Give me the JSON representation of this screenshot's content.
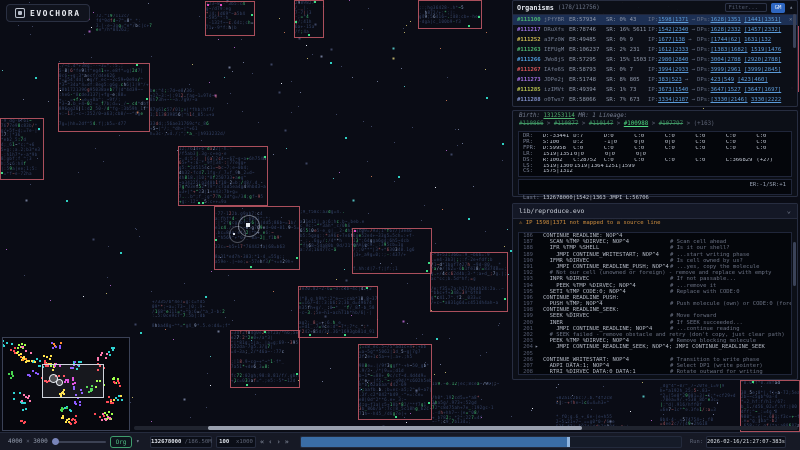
{
  "app": {
    "title": "EVOCHORA"
  },
  "organisms_panel": {
    "title": "Organisms",
    "count": "(178/112756)",
    "filter_placeholder": "Filter...",
    "gm_button": "GM",
    "collapse_icon": "▴",
    "close_icon": "×",
    "ip_label": "IP:",
    "dp_label": "DPs:",
    "rows": [
      {
        "id": "#111100",
        "id_color": "#4db56f",
        "name": "jPfYBR",
        "er": "ER:57934",
        "sr": "SR: 0% 43",
        "ip": "1598|1371",
        "dir": "→",
        "dp1": "1628|1351",
        "dp2": "[1441|1351]",
        "selected": true
      },
      {
        "id": "#111217",
        "id_color": "#9a6fe0",
        "name": "DRuXfs",
        "er": "ER:78746",
        "sr": "SR: 16% 5611",
        "ip": "1542|2340",
        "dir": "→",
        "dp1": "1628|2332",
        "dp2": "[1457|2332]",
        "selected": false
      },
      {
        "id": "#111252",
        "id_color": "#cdb94f",
        "name": "a3Fz0W",
        "er": "ER:49485",
        "sr": "SR: 0% 9",
        "ip": "1677|138",
        "dir": "→",
        "dp1": "[1744|62]",
        "dp2": "1631|132",
        "selected": false
      },
      {
        "id": "#111263",
        "id_color": "#4db56f",
        "name": "IEFUgM",
        "er": "ER:106237",
        "sr": "SR: 2% 231",
        "ip": "1612|2333",
        "dir": "→",
        "dp1": "[1383|1682]",
        "dp2": "1519|1476",
        "selected": false
      },
      {
        "id": "#111266",
        "id_color": "#4f9fe0",
        "name": "JWo8jS",
        "er": "ER:57295",
        "sr": "SR: 15% 1503",
        "ip": "2980|2840",
        "dir": "→",
        "dp1": "3004|2788",
        "dp2": "[2920|2788]",
        "selected": false
      },
      {
        "id": "#111267",
        "id_color": "#d9565a",
        "name": "IAfe6S",
        "er": "ER:58793",
        "sr": "SR: 0% 7",
        "ip": "3994|2933",
        "dir": "→",
        "dp1": "3999|2961",
        "dp2": "[3999|2845]",
        "selected": false
      },
      {
        "id": "#111273",
        "id_color": "#a06fe0",
        "name": "JDPe2j",
        "er": "ER:51748",
        "sr": "SR: 8% 805",
        "ip": "383|523",
        "dir": "→",
        "dp1": "423|549",
        "dp2": "[423|460]",
        "selected": false
      },
      {
        "id": "#111285",
        "id_color": "#b9c24f",
        "name": "izIMVt",
        "er": "ER:49394",
        "sr": "SR: 1% 73",
        "ip": "3673|1540",
        "dir": "→",
        "dp1": "3647|1527",
        "dp2": "[3647|1697]",
        "selected": false
      },
      {
        "id": "#111288",
        "id_color": "#7f8fc9",
        "name": "o0Tws7",
        "er": "ER:58066",
        "sr": "SR: 7% 673",
        "ip": "3334|2187",
        "dir": "→",
        "dp1": "[3330|2146]",
        "dp2": "3330|2222",
        "selected": false
      }
    ]
  },
  "details_panel": {
    "birth_label": "Birth: ",
    "birth_value": "131253114",
    "mr_label": " MR: 1 ",
    "lineage_label": "Lineage:",
    "lineage": [
      {
        "id": "#110866",
        "status": "dead"
      },
      {
        "id": "#110877",
        "status": "dead"
      },
      {
        "id": "#110147",
        "status": "dead"
      },
      {
        "id": "#100988",
        "status": "live"
      },
      {
        "id": "#107797",
        "status": "dead"
      }
    ],
    "lineage_sep": " > ",
    "lineage_more": "(+163)",
    "registers": [
      {
        "label": "DR:",
        "values": [
          "D:-33441",
          "D:7",
          "D:0",
          "C:0",
          "C:0",
          "C:0",
          "C:0",
          "C:0"
        ]
      },
      {
        "label": "PR:",
        "values": [
          "S:100",
          "D:2",
          "-1|0",
          "0|0",
          "0|0",
          "C:0",
          "C:0",
          "C:0"
        ]
      },
      {
        "label": "FPR:",
        "values": [
          "D:59958",
          "C:0",
          "C:0",
          "C:0",
          "C:0",
          "C:0",
          "C:0",
          "C:0"
        ]
      },
      {
        "label": "LR:",
        "values": [
          "1519|1351",
          "0|0",
          "0|0",
          "0|0"
        ]
      },
      {
        "label": "DS:",
        "values": [
          "R:1002",
          "C:28752",
          "C:0",
          "C:0",
          "C:0",
          "C:0",
          "L:366829",
          "(+27)"
        ]
      },
      {
        "label": "LS:",
        "values": [
          "1519|1300",
          "1519|1364",
          "1251|1599"
        ]
      },
      {
        "label": "CS:",
        "values": [
          "1575|1312"
        ]
      }
    ],
    "last_label": "Last: ",
    "last_value": "132678000|1542|1363 JMPI L:56706",
    "last_er": "ER:-1/SR:+1",
    "next_label": "Next: ",
    "next_value": "132678001|1598|1371 SEEK %PR2",
    "next_green": "=-1|0"
  },
  "source_panel": {
    "file": "lib/reproduce.evo",
    "chevron": "⌄",
    "warning_icon": "⚠",
    "warning_text": " IP 1598|1371 not mapped to a source line",
    "marker_icon": "▸",
    "lines": [
      {
        "n": "186",
        "code": "CONTINUE_READLINE: NOP^4",
        "cm": ""
      },
      {
        "n": "187",
        "code": "  SCAN %TMP %DIRVEC; NOP^4",
        "cm": "# Scan cell ahead"
      },
      {
        "n": "188",
        "code": "  IFR %TMP %SHELL",
        "cm": "# Is it our shell?"
      },
      {
        "n": "189",
        "code": "    JMPI CONTINUE_WRITESTART; NOP^4",
        "cm": "# ...start writing phase"
      },
      {
        "n": "190",
        "code": "  IFMR %DIRVEC",
        "cm": "# Is cell owned by us?"
      },
      {
        "n": "191",
        "code": "    JMPI CONTINUE_READLINE_PUSH; NOP^4",
        "cm": "# ...yes, copy the molecule"
      },
      {
        "n": "192",
        "code": "  # Not our cell (unowned or foreign) - remove and replace with empty",
        "cm": "",
        "comment_line": true
      },
      {
        "n": "193",
        "code": "  INPR %DIRVEC",
        "cm": "# If not passable..."
      },
      {
        "n": "194",
        "code": "    PEEK %TMP %DIRVEC; NOP^4",
        "cm": "# ...remove it"
      },
      {
        "n": "195",
        "code": "  SETI %TMP CODE:0; NOP^4",
        "cm": "# Replace with CODE:0"
      },
      {
        "n": "196",
        "code": "CONTINUE_READLINE_PUSH:",
        "cm": ""
      },
      {
        "n": "197",
        "code": "  PUSH %TMP; NOP^4",
        "cm": "# Push molecule (own) or CODE:0 (foreign/unowned)"
      },
      {
        "n": "198",
        "code": "CONTINUE_READLINE_SEEK:",
        "cm": ""
      },
      {
        "n": "199",
        "code": "  SEEK %DIRVEC",
        "cm": "# Move forward"
      },
      {
        "n": "200",
        "code": "  INER",
        "cm": "# If SEEK succeeded..."
      },
      {
        "n": "201",
        "code": "    JMPI CONTINUE_READLINE; NOP^4",
        "cm": "# ...continue reading"
      },
      {
        "n": "202",
        "code": "  # SEEK failed - remove obstacle and retry (don't copy, just clear path)",
        "cm": "",
        "comment_line": true
      },
      {
        "n": "203",
        "code": "  PEEK %TMP %DIRVEC; NOP^4",
        "cm": "# Remove blocking molecule"
      },
      {
        "n": "204",
        "code": "    JMPI CONTINUE_READLINE_SEEK; NOP^4; JMPI CONTINUE_READLINE_SEEK",
        "cm": "",
        "marker": true
      },
      {
        "n": "205",
        "code": "",
        "cm": ""
      },
      {
        "n": "206",
        "code": "CONTINUE_WRITESTART: NOP^4",
        "cm": "# Transition to write phase"
      },
      {
        "n": "207",
        "code": "  ADPI DATA:1; NOP^4",
        "cm": "# Select DP1 (write pointer)"
      },
      {
        "n": "208",
        "code": "  RTRI %DIRVEC DATA:0 DATA:1",
        "cm": "# Rotate outward for writing"
      }
    ]
  },
  "minimap": {
    "viewport": {
      "x": 39,
      "y": 26,
      "w": 62,
      "h": 34
    },
    "rings": [
      {
        "x": 46,
        "y": 36,
        "d": 7
      },
      {
        "x": 53,
        "y": 41,
        "d": 5
      }
    ]
  },
  "toolbar": {
    "world_w": "4000",
    "world_x": " × ",
    "world_h": "3000",
    "org_button": "Org",
    "org_caret": "▾",
    "tick": "132678000",
    "tick_total": " /186.50M",
    "speed": "100",
    "speed_mult": "  x1000",
    "controls": [
      "«",
      "‹",
      "›",
      "»"
    ],
    "progress_pct": 70.4,
    "run_label": "Run:",
    "run_value": "2026-02-16/21:27:07-383s"
  },
  "world": {
    "clusters": [
      {
        "x": 96,
        "y": 14,
        "w": 62,
        "h": 22,
        "b": 0
      },
      {
        "x": 205,
        "y": 1,
        "w": 48,
        "h": 33,
        "b": 1
      },
      {
        "x": 294,
        "y": 0,
        "w": 28,
        "h": 36,
        "b": 1
      },
      {
        "x": 418,
        "y": 0,
        "w": 62,
        "h": 27,
        "b": 1
      },
      {
        "x": 58,
        "y": 63,
        "w": 90,
        "h": 67,
        "b": 1
      },
      {
        "x": 150,
        "y": 84,
        "w": 84,
        "h": 57,
        "b": 0
      },
      {
        "x": 0,
        "y": 118,
        "w": 42,
        "h": 60,
        "b": 1
      },
      {
        "x": 178,
        "y": 146,
        "w": 88,
        "h": 58,
        "b": 1
      },
      {
        "x": 214,
        "y": 206,
        "w": 84,
        "h": 62,
        "b": 1
      },
      {
        "x": 300,
        "y": 210,
        "w": 70,
        "h": 46,
        "b": 0
      },
      {
        "x": 352,
        "y": 228,
        "w": 78,
        "h": 44,
        "b": 1
      },
      {
        "x": 430,
        "y": 252,
        "w": 76,
        "h": 58,
        "b": 1
      },
      {
        "x": 298,
        "y": 286,
        "w": 78,
        "h": 50,
        "b": 1
      },
      {
        "x": 152,
        "y": 300,
        "w": 78,
        "h": 30,
        "b": 0
      },
      {
        "x": 230,
        "y": 330,
        "w": 68,
        "h": 56,
        "b": 1
      },
      {
        "x": 358,
        "y": 344,
        "w": 72,
        "h": 74,
        "b": 1
      },
      {
        "x": 432,
        "y": 382,
        "w": 76,
        "h": 46,
        "b": 0
      },
      {
        "x": 556,
        "y": 396,
        "w": 72,
        "h": 34,
        "b": 0
      },
      {
        "x": 660,
        "y": 384,
        "w": 76,
        "h": 46,
        "b": 0
      },
      {
        "x": 740,
        "y": 380,
        "w": 58,
        "h": 50,
        "b": 1
      }
    ],
    "teal_markers": [
      [
        35,
        77
      ],
      [
        66,
        200
      ],
      [
        120,
        252
      ],
      [
        345,
        137
      ],
      [
        398,
        176
      ],
      [
        486,
        97
      ],
      [
        502,
        143
      ],
      [
        330,
        62
      ],
      [
        468,
        218
      ],
      [
        205,
        296
      ],
      [
        140,
        332
      ],
      [
        436,
        338
      ],
      [
        510,
        250
      ],
      [
        38,
        128
      ]
    ],
    "magenta_markers": [
      [
        207,
        4
      ],
      [
        220,
        4
      ],
      [
        794,
        27
      ],
      [
        791,
        87
      ],
      [
        354,
        230
      ],
      [
        88,
        18
      ]
    ],
    "red_edge_line": {
      "x": 797,
      "y": 26,
      "h": 66
    },
    "selection_rings": [
      {
        "x": 238,
        "y": 215,
        "d": 20,
        "o": 0.55
      },
      {
        "x": 229,
        "y": 226,
        "d": 15,
        "o": 0.35
      }
    ],
    "ip_marker": {
      "x": 246,
      "y": 223
    },
    "dp_marker": {
      "x": 233,
      "y": 233
    },
    "star_count": 340,
    "star_seed": 13
  }
}
